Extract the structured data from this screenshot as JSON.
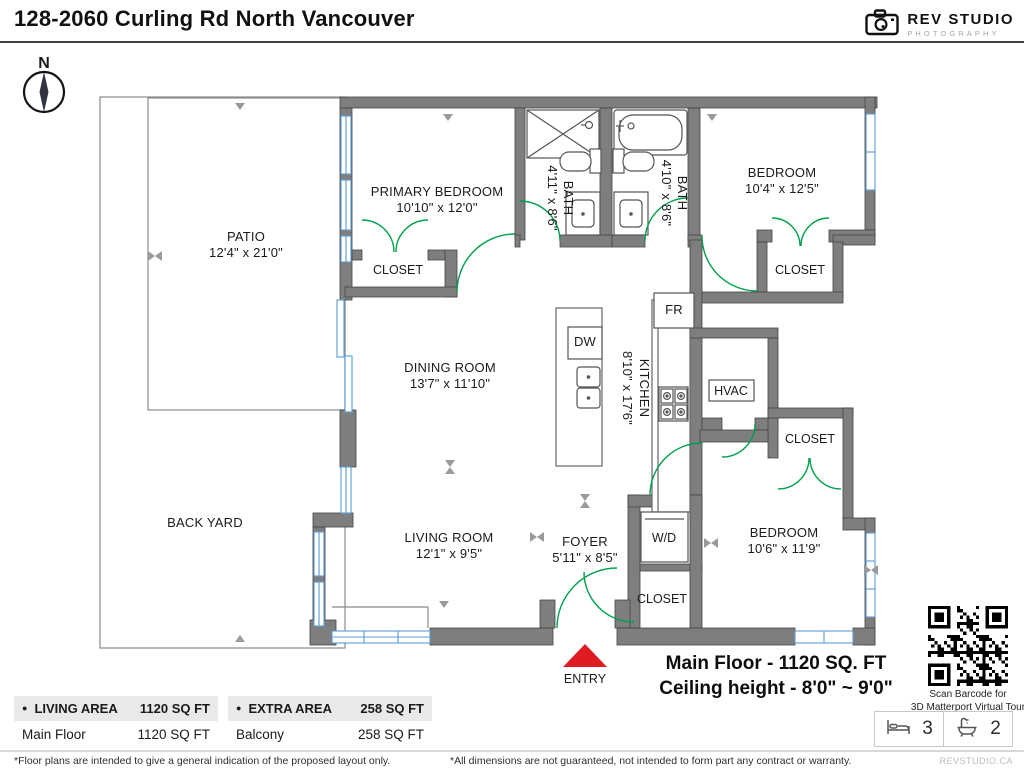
{
  "header": {
    "title": "128-2060 Curling Rd North Vancouver",
    "logo_name": "REV STUDIO",
    "logo_sub": "PHOTOGRAPHY"
  },
  "compass": {
    "label": "N"
  },
  "plan": {
    "patio": {
      "name": "PATIO",
      "dims": "12'4\" x 21'0\""
    },
    "back_yard": {
      "name": "BACK YARD"
    },
    "primary_bedroom": {
      "name": "PRIMARY BEDROOM",
      "dims": "10'10\" x 12'0\""
    },
    "bath1": {
      "name": "BATH",
      "dims": "4'11\" x 8'6\""
    },
    "bath2": {
      "name": "BATH",
      "dims": "4'10\" x 8'6\""
    },
    "bedroom2": {
      "name": "BEDROOM",
      "dims": "10'4\" x 12'5\""
    },
    "dining_room": {
      "name": "DINING ROOM",
      "dims": "13'7\" x 11'10\""
    },
    "kitchen": {
      "name": "KITCHEN",
      "dims": "8'10\" x 17'6\""
    },
    "living_room": {
      "name": "LIVING ROOM",
      "dims": "12'1\" x 9'5\""
    },
    "foyer": {
      "name": "FOYER",
      "dims": "5'11\" x 8'5\""
    },
    "bedroom3": {
      "name": "BEDROOM",
      "dims": "10'6\" x 11'9\""
    },
    "closet": "CLOSET",
    "labels": {
      "fr": "FR",
      "dw": "DW",
      "hvac": "HVAC",
      "wd": "W/D",
      "entry": "ENTRY"
    }
  },
  "summary": {
    "line1": "Main Floor - 1120 SQ. FT",
    "line2": "Ceiling height - 8'0\" ~ 9'0\""
  },
  "qr": {
    "line1": "Scan Barcode for",
    "line2": "3D Matterport Virtual Tour"
  },
  "stats": {
    "beds": "3",
    "baths": "2"
  },
  "tables": {
    "bullet": "●",
    "living": {
      "title": "LIVING AREA",
      "total": "1120 SQ FT",
      "rows": [
        {
          "label": "Main Floor",
          "value": "1120 SQ FT"
        }
      ]
    },
    "extra": {
      "title": "EXTRA AREA",
      "total": "258 SQ FT",
      "rows": [
        {
          "label": "Balcony",
          "value": "258 SQ FT"
        }
      ]
    }
  },
  "footer": {
    "left": "*Floor plans are intended to give a general indication of the proposed layout only.",
    "center": "*All dimensions are not guaranteed, not intended to form part any contract or warranty.",
    "right": "REVSTUDIO.CA"
  },
  "colors": {
    "wall": "#7e7e7e",
    "door": "#00a14b",
    "window": "#5b9bd5",
    "entry_red": "#e01b24",
    "table_header_bg": "#e9e9e9"
  }
}
